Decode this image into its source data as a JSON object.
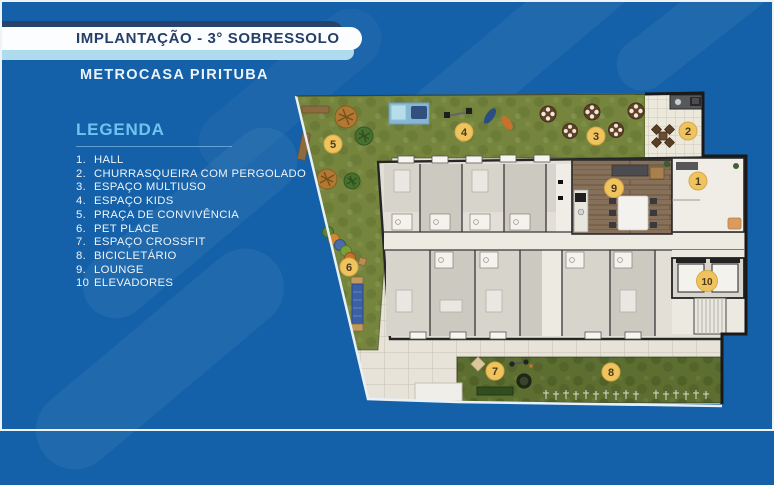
{
  "header": {
    "title": "IMPLANTAÇÃO - 3° SOBRESSOLO",
    "subtitle": "METROCASA PIRITUBA"
  },
  "legend": {
    "heading": "LEGENDA",
    "items": [
      {
        "num": "1.",
        "label": "HALL"
      },
      {
        "num": "2.",
        "label": "CHURRASQUEIRA COM PERGOLADO"
      },
      {
        "num": "3.",
        "label": "ESPAÇO MULTIUSO"
      },
      {
        "num": "4.",
        "label": "ESPAÇO KIDS"
      },
      {
        "num": "5.",
        "label": "PRAÇA DE CONVIVÊNCIA"
      },
      {
        "num": "6.",
        "label": "PET PLACE"
      },
      {
        "num": "7.",
        "label": "ESPAÇO CROSSFIT"
      },
      {
        "num": "8.",
        "label": "BICICLETÁRIO"
      },
      {
        "num": "9.",
        "label": "LOUNGE"
      },
      {
        "num": "10",
        "label": "ELEVADORES"
      }
    ]
  },
  "plan": {
    "markers": [
      {
        "num": "1"
      },
      {
        "num": "2"
      },
      {
        "num": "3"
      },
      {
        "num": "4"
      },
      {
        "num": "5"
      },
      {
        "num": "6"
      },
      {
        "num": "7"
      },
      {
        "num": "8"
      },
      {
        "num": "9"
      },
      {
        "num": "10"
      }
    ]
  },
  "colors": {
    "background_blue": "#1561a9",
    "banner_navy": "#27436b",
    "banner_light_blue": "#aedcee",
    "banner_white": "#fbfdfe",
    "title_text_navy": "#253f69",
    "legend_heading_blue": "#70c3ee",
    "legend_text": "#eef4f9",
    "marker_yellow": "#efc35d",
    "lawn_green": "#75853e",
    "bike_strip_green": "#5d6e31",
    "paving": "#e7e3d8",
    "building_wall": "#262626",
    "lounge_wood": "#87705a"
  }
}
